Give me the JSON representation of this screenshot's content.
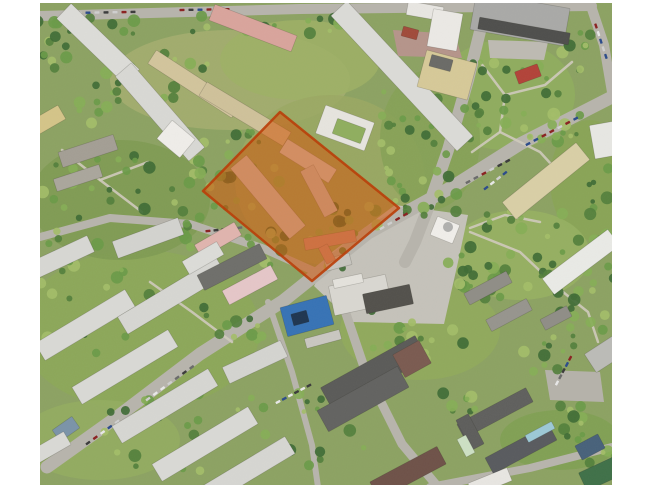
{
  "scene": {
    "description": "oblique-aerial-photo-residential-district-with-highlighted-site",
    "canvas": {
      "width": 650,
      "height": 487,
      "background": "#ffffff"
    },
    "photo": {
      "x": 40,
      "y": 3,
      "width": 572,
      "height": 482,
      "base_color": "#8ca262"
    },
    "palette": {
      "road": "#b7b4ac",
      "path": "#cfcabc",
      "building_stroke": "rgba(40,40,30,0.22)",
      "tree_shades": [
        "#3f6b35",
        "#527f3c",
        "#6a9a48",
        "#86ae56",
        "#a3bd68"
      ],
      "car_colors": [
        "#3a3a3a",
        "#e8e8e8",
        "#8a2020",
        "#2a4a8a",
        "#6a6a6a",
        "#cfcfcf"
      ]
    },
    "highlight": {
      "label": "highlighted-site",
      "points": [
        [
          280,
          112
        ],
        [
          399,
          208
        ],
        [
          312,
          281
        ],
        [
          203,
          191
        ]
      ],
      "fill": "rgba(210,85,10,0.55)",
      "stroke": "rgba(185,60,5,0.9)",
      "stroke_width": 2.5
    },
    "grass_patches": [
      [
        230,
        80,
        120,
        50,
        "#a4ae70"
      ],
      [
        300,
        60,
        80,
        40,
        "#9db065"
      ],
      [
        505,
        95,
        70,
        55,
        "#8fae5e"
      ],
      [
        590,
        180,
        40,
        60,
        "#88a455"
      ],
      [
        520,
        255,
        70,
        45,
        "#97b162"
      ],
      [
        330,
        180,
        95,
        85,
        "#9aa863"
      ],
      [
        140,
        330,
        120,
        80,
        "#8ca858"
      ],
      [
        420,
        330,
        80,
        50,
        "#90aa5c"
      ],
      [
        100,
        440,
        80,
        40,
        "#93ad60"
      ],
      [
        560,
        440,
        60,
        30,
        "#7fa052"
      ],
      [
        120,
        200,
        90,
        60,
        "#7e9a52"
      ],
      [
        430,
        140,
        50,
        70,
        "#85a156"
      ]
    ],
    "paved_areas": [
      {
        "points": [
          [
            395,
            205
          ],
          [
            468,
            215
          ],
          [
            458,
            262
          ],
          [
            444,
            324
          ],
          [
            352,
            322
          ],
          [
            314,
            286
          ],
          [
            332,
            252
          ]
        ],
        "color": "#c5c2ba"
      },
      {
        "points": [
          [
            393,
            30
          ],
          [
            455,
            34
          ],
          [
            462,
            58
          ],
          [
            398,
            56
          ]
        ],
        "color": "#b5948a"
      },
      {
        "points": [
          [
            545,
            370
          ],
          [
            600,
            372
          ],
          [
            604,
            402
          ],
          [
            550,
            400
          ]
        ],
        "color": "#b5b2aa"
      },
      {
        "points": [
          [
            488,
            40
          ],
          [
            548,
            42
          ],
          [
            544,
            60
          ],
          [
            490,
            58
          ]
        ],
        "color": "#bdbab2"
      }
    ],
    "roads": [
      {
        "points": [
          [
            40,
            16
          ],
          [
            300,
            9
          ],
          [
            592,
            6
          ]
        ],
        "width": 10
      },
      {
        "points": [
          [
            487,
            3
          ],
          [
            468,
            80
          ],
          [
            448,
            150
          ],
          [
            428,
            208
          ],
          [
            415,
            242
          ],
          [
            405,
            262
          ]
        ],
        "width": 12
      },
      {
        "points": [
          [
            612,
            97
          ],
          [
            520,
            144
          ],
          [
            452,
            187
          ],
          [
            368,
            233
          ],
          [
            283,
            301
          ],
          [
            200,
            354
          ],
          [
            117,
            417
          ],
          [
            47,
            467
          ]
        ],
        "width": 13
      },
      {
        "points": [
          [
            590,
            3
          ],
          [
            604,
            45
          ],
          [
            612,
            92
          ]
        ],
        "width": 10
      },
      {
        "points": [
          [
            338,
            290
          ],
          [
            365,
            370
          ],
          [
            402,
            444
          ],
          [
            438,
            487
          ]
        ],
        "width": 9
      },
      {
        "points": [
          [
            430,
            487
          ],
          [
            530,
            468
          ],
          [
            612,
            447
          ]
        ],
        "width": 8
      },
      {
        "points": [
          [
            40,
            237
          ],
          [
            110,
            218
          ],
          [
            190,
            224
          ],
          [
            262,
            248
          ],
          [
            316,
            272
          ]
        ],
        "width": 8
      },
      {
        "points": [
          [
            268,
            302
          ],
          [
            292,
            372
          ],
          [
            312,
            445
          ],
          [
            318,
            487
          ]
        ],
        "width": 6
      }
    ],
    "paths": [
      {
        "points": [
          [
            480,
            62
          ],
          [
            505,
            95
          ],
          [
            500,
            132
          ],
          [
            472,
            152
          ]
        ]
      },
      {
        "points": [
          [
            505,
            95
          ],
          [
            545,
            85
          ],
          [
            572,
            62
          ]
        ]
      },
      {
        "points": [
          [
            500,
            132
          ],
          [
            540,
            152
          ],
          [
            562,
            176
          ]
        ]
      },
      {
        "points": [
          [
            470,
            232
          ],
          [
            520,
            252
          ],
          [
            558,
            288
          ]
        ]
      },
      {
        "points": [
          [
            558,
            288
          ],
          [
            588,
            312
          ],
          [
            598,
            342
          ]
        ]
      },
      {
        "points": [
          [
            62,
            150
          ],
          [
            100,
            180
          ],
          [
            142,
            212
          ]
        ]
      },
      {
        "points": [
          [
            100,
            180
          ],
          [
            148,
            162
          ]
        ]
      },
      {
        "points": [
          [
            150,
            282
          ],
          [
            192,
            312
          ],
          [
            232,
            342
          ]
        ]
      },
      {
        "points": [
          [
            470,
            228
          ],
          [
            505,
            215
          ],
          [
            540,
            222
          ]
        ]
      }
    ],
    "buildings": [
      [
        98,
        44,
        95,
        21,
        44,
        "#dcdcd8"
      ],
      [
        160,
        112,
        112,
        21,
        49,
        "#d8d8d4"
      ],
      [
        176,
        139,
        30,
        24,
        40,
        "#efede9"
      ],
      [
        253,
        28,
        88,
        17,
        21,
        "#d9a49c"
      ],
      [
        194,
        84,
        100,
        16,
        33,
        "#d2c49c"
      ],
      [
        245,
        114,
        98,
        16,
        31,
        "#cfc19a"
      ],
      [
        48,
        120,
        32,
        16,
        -30,
        "#d4c488"
      ],
      [
        88,
        151,
        58,
        16,
        -18,
        "#a39e94"
      ],
      [
        78,
        178,
        48,
        13,
        -18,
        "#aaa69c"
      ],
      [
        402,
        76,
        185,
        22,
        47,
        "#dbdbd7"
      ],
      [
        425,
        11,
        36,
        14,
        10,
        "#e8e6e2"
      ],
      [
        410,
        33,
        16,
        10,
        15,
        "#a04a3a"
      ],
      [
        445,
        30,
        30,
        38,
        10,
        "#ebe9e5"
      ],
      [
        447,
        75,
        52,
        38,
        15,
        "#d6c998"
      ],
      [
        441,
        63,
        22,
        12,
        15,
        "#6a6a66"
      ],
      [
        520,
        19,
        95,
        38,
        10,
        "#a9a9a7"
      ],
      [
        524,
        31,
        92,
        12,
        10,
        "#4e4e4c"
      ],
      [
        528,
        74,
        24,
        13,
        -20,
        "#b24238"
      ],
      [
        345,
        128,
        52,
        30,
        20,
        "#e6e4de"
      ],
      [
        349,
        131,
        30,
        16,
        20,
        "#8fae5e"
      ],
      [
        546,
        181,
        95,
        22,
        -39,
        "#d9cfa6"
      ],
      [
        581,
        262,
        82,
        20,
        -37,
        "#e9eae6"
      ],
      [
        605,
        140,
        26,
        34,
        -10,
        "#e7e7e3"
      ],
      [
        608,
        352,
        42,
        22,
        -33,
        "#bbbbb7"
      ],
      [
        360,
        295,
        58,
        30,
        -12,
        "#d9d7d1"
      ],
      [
        338,
        262,
        26,
        12,
        -15,
        "#c6c4be"
      ],
      [
        388,
        299,
        48,
        20,
        -12,
        "#52504b"
      ],
      [
        348,
        281,
        30,
        9,
        -12,
        "#e4e2dc"
      ],
      [
        445,
        230,
        24,
        20,
        22,
        "#f0eeea"
      ],
      [
        330,
        240,
        52,
        12,
        -10,
        "#c99084"
      ],
      [
        327,
        254,
        18,
        10,
        62,
        "#c99084"
      ],
      [
        268,
        197,
        92,
        21,
        50,
        "#cfccc8"
      ],
      [
        308,
        161,
        58,
        16,
        32,
        "#d4d1cd"
      ],
      [
        319,
        191,
        52,
        15,
        62,
        "#c9c6c2"
      ],
      [
        374,
        373,
        108,
        26,
        -29,
        "#5a5a58"
      ],
      [
        412,
        359,
        30,
        26,
        -29,
        "#7a5a50"
      ],
      [
        363,
        399,
        92,
        24,
        -29,
        "#626260"
      ],
      [
        488,
        288,
        48,
        13,
        -28,
        "#8f8d86"
      ],
      [
        509,
        315,
        46,
        13,
        -28,
        "#96948d"
      ],
      [
        556,
        318,
        30,
        12,
        -28,
        "#8f8d86"
      ],
      [
        495,
        413,
        78,
        16,
        -28,
        "#5f5f5d"
      ],
      [
        521,
        449,
        72,
        18,
        -28,
        "#585a5e"
      ],
      [
        540,
        432,
        30,
        8,
        -28,
        "#9cc8d6"
      ],
      [
        470,
        432,
        34,
        14,
        62,
        "#5d5d5b"
      ],
      [
        466,
        446,
        20,
        10,
        62,
        "#cde0c4"
      ],
      [
        600,
        474,
        38,
        20,
        -25,
        "#3f7048"
      ],
      [
        590,
        447,
        26,
        16,
        -28,
        "#47617a"
      ],
      [
        408,
        473,
        76,
        20,
        -28,
        "#6e5148"
      ],
      [
        490,
        482,
        42,
        14,
        -22,
        "#e8e6e2"
      ],
      [
        307,
        316,
        48,
        30,
        -15,
        "#3672b5"
      ],
      [
        300,
        318,
        16,
        12,
        -15,
        "#1e3550"
      ],
      [
        323,
        339,
        36,
        10,
        -15,
        "#c9c7c1"
      ],
      [
        60,
        258,
        68,
        18,
        -25,
        "#d7d7d3"
      ],
      [
        148,
        238,
        70,
        18,
        -20,
        "#d3d3cf"
      ],
      [
        85,
        325,
        105,
        20,
        -31,
        "#d9d9d5"
      ],
      [
        172,
        296,
        115,
        20,
        -31,
        "#d6d6d2"
      ],
      [
        125,
        367,
        112,
        20,
        -31,
        "#d9d9d5"
      ],
      [
        165,
        406,
        112,
        20,
        -31,
        "#d6d6d2"
      ],
      [
        205,
        444,
        112,
        20,
        -31,
        "#d9d9d5"
      ],
      [
        245,
        472,
        105,
        20,
        -31,
        "#d6d6d2"
      ],
      [
        255,
        362,
        64,
        18,
        -25,
        "#d4d4d0"
      ],
      [
        232,
        267,
        70,
        17,
        -27,
        "#6e6e6a"
      ],
      [
        250,
        285,
        55,
        16,
        -28,
        "#e5c6c8"
      ],
      [
        218,
        240,
        46,
        15,
        -30,
        "#e0b4ae"
      ],
      [
        203,
        258,
        40,
        15,
        -30,
        "#dcdcd8"
      ],
      [
        66,
        429,
        24,
        14,
        -35,
        "#7a93a8"
      ],
      [
        50,
        448,
        40,
        15,
        -30,
        "#d9d9d5"
      ]
    ],
    "circles": [
      [
        448,
        227,
        5,
        "#b0b0ae"
      ]
    ],
    "tree_clusters": [
      [
        190,
        25,
        150,
        9,
        24
      ],
      [
        150,
        75,
        60,
        25,
        16
      ],
      [
        120,
        200,
        80,
        45,
        38
      ],
      [
        240,
        170,
        45,
        40,
        24
      ],
      [
        300,
        245,
        55,
        25,
        18
      ],
      [
        420,
        145,
        40,
        60,
        26
      ],
      [
        505,
        100,
        55,
        45,
        26
      ],
      [
        520,
        250,
        60,
        40,
        28
      ],
      [
        600,
        220,
        14,
        60,
        14
      ],
      [
        585,
        310,
        28,
        28,
        14
      ],
      [
        430,
        340,
        60,
        30,
        18
      ],
      [
        575,
        420,
        25,
        20,
        10
      ],
      [
        460,
        398,
        18,
        18,
        8
      ],
      [
        130,
        300,
        90,
        55,
        26
      ],
      [
        180,
        432,
        90,
        40,
        22
      ],
      [
        330,
        430,
        40,
        40,
        16
      ],
      [
        575,
        50,
        25,
        20,
        10
      ],
      [
        560,
        125,
        30,
        12,
        10
      ],
      [
        430,
        205,
        28,
        12,
        9
      ],
      [
        240,
        330,
        30,
        14,
        9
      ],
      [
        55,
        40,
        18,
        28,
        10
      ],
      [
        95,
        105,
        25,
        18,
        8
      ],
      [
        605,
        460,
        18,
        10,
        6
      ],
      [
        350,
        220,
        30,
        15,
        10
      ],
      [
        475,
        280,
        35,
        20,
        12
      ],
      [
        545,
        355,
        30,
        18,
        10
      ]
    ],
    "car_rows": [
      [
        70,
        13,
        -1,
        8,
        9
      ],
      [
        182,
        10,
        -1,
        6,
        9
      ],
      [
        596,
        26,
        72,
        5,
        8
      ],
      [
        528,
        144,
        -28,
        7,
        9
      ],
      [
        468,
        182,
        -28,
        6,
        9
      ],
      [
        382,
        228,
        -30,
        4,
        9
      ],
      [
        148,
        399,
        -36,
        7,
        9
      ],
      [
        88,
        443,
        -36,
        5,
        9
      ],
      [
        278,
        402,
        -28,
        6,
        7
      ],
      [
        557,
        383,
        -62,
        5,
        7
      ],
      [
        208,
        231,
        -6,
        5,
        8
      ],
      [
        486,
        188,
        -38,
        4,
        8
      ]
    ]
  }
}
